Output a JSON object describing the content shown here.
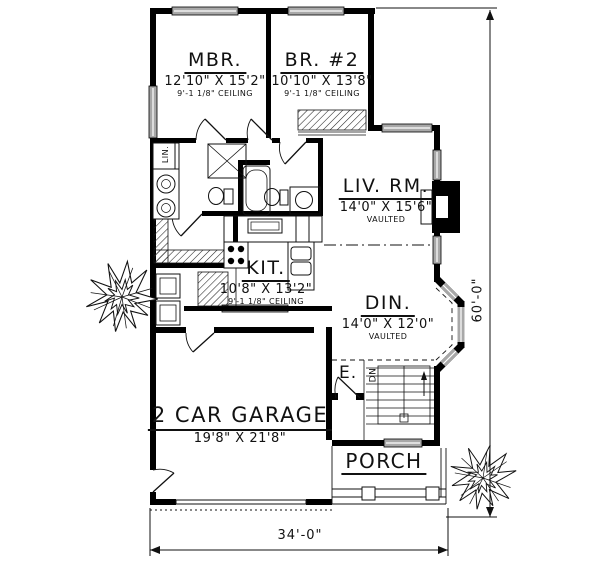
{
  "plan": {
    "type": "house-floor-plan",
    "rooms": [
      {
        "name": "MBR.",
        "dimensions": "12'10\" X 15'2\"",
        "ceiling": "9'-1 1/8\" CEILING"
      },
      {
        "name": "BR. #2",
        "dimensions": "10'10\" X 13'8\"",
        "ceiling": "9'-1 1/8\" CEILING"
      },
      {
        "name": "LIV. RM.",
        "dimensions": "14'0\" X 15'6\"",
        "ceiling": "VAULTED"
      },
      {
        "name": "KIT.",
        "dimensions": "10'8\" X 13'2\"",
        "ceiling": "9'-1 1/8\" CEILING"
      },
      {
        "name": "DIN.",
        "dimensions": "14'0\" X 12'0\"",
        "ceiling": "VAULTED"
      },
      {
        "name": "2 CAR GARAGE",
        "dimensions": "19'8\" X 21'8\"",
        "ceiling": ""
      },
      {
        "name": "PORCH",
        "dimensions": "",
        "ceiling": ""
      }
    ],
    "labels": {
      "entry": "E.",
      "stairs_direction": "DN",
      "linen_closet": "LIN."
    },
    "overall_dimensions": {
      "width": "34'-0\"",
      "height": "60'-0\""
    },
    "colors": {
      "wall": "#000000",
      "window_fill": "#a8a8a8",
      "background": "#ffffff"
    }
  }
}
